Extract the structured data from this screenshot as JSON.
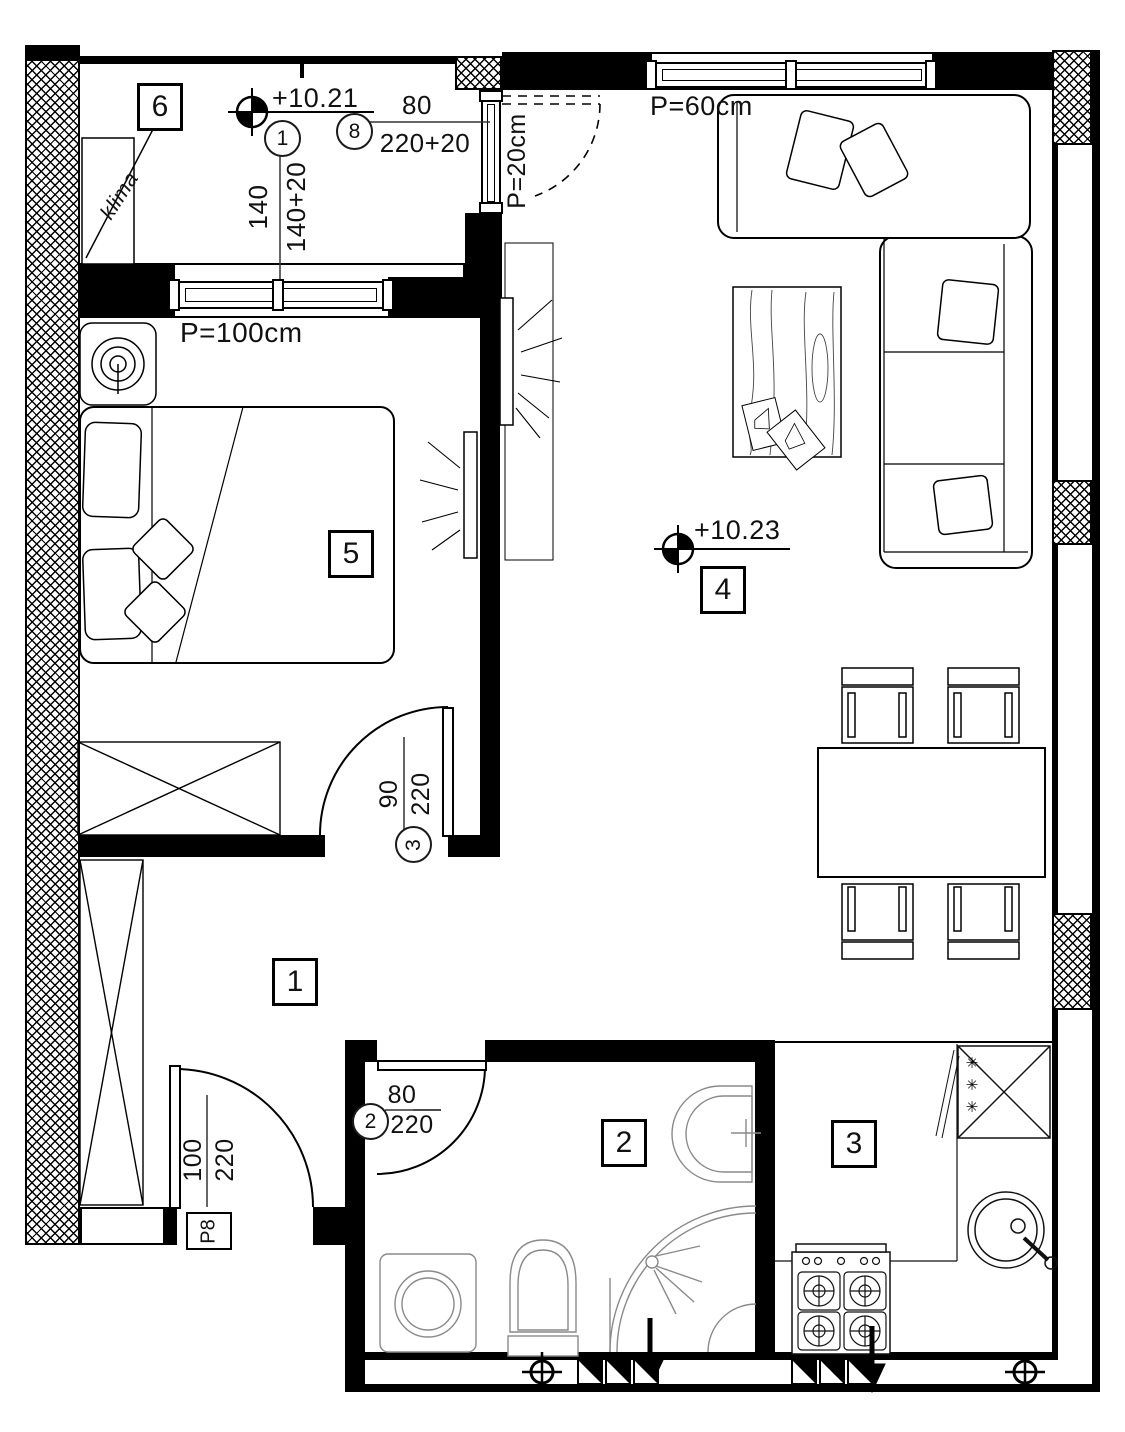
{
  "drawing": {
    "kind": "apartment-floor-plan",
    "levels": {
      "balcony": "+10.21",
      "living": "+10.23"
    },
    "rooms": {
      "r1": "1",
      "r2": "2",
      "r3": "3",
      "r4": "4",
      "r5": "5",
      "r6": "6"
    },
    "tags": {
      "window": "1",
      "balcony_door": "8",
      "bedroom_door": "3",
      "bathroom_door": "2"
    },
    "dims": {
      "balcony_window_w": "140",
      "balcony_window_h": "140+20",
      "balcony_door_w": "80",
      "balcony_door_h": "220+20",
      "bedroom_door_w": "90",
      "bedroom_door_h": "220",
      "bathroom_door_w": "80",
      "bathroom_door_h": "220",
      "entrance_w": "100",
      "entrance_h": "220",
      "entrance_mark": "P8"
    },
    "parapets": {
      "bedroom_window": "P=100cm",
      "balcony_door": "P=20cm",
      "living_window": "P=60cm"
    },
    "labels": {
      "ac": "klima",
      "freezer_stars": "✳✳✳"
    },
    "colors": {
      "line": "#000000",
      "fixture": "#8a8a8a",
      "background": "#ffffff"
    }
  }
}
